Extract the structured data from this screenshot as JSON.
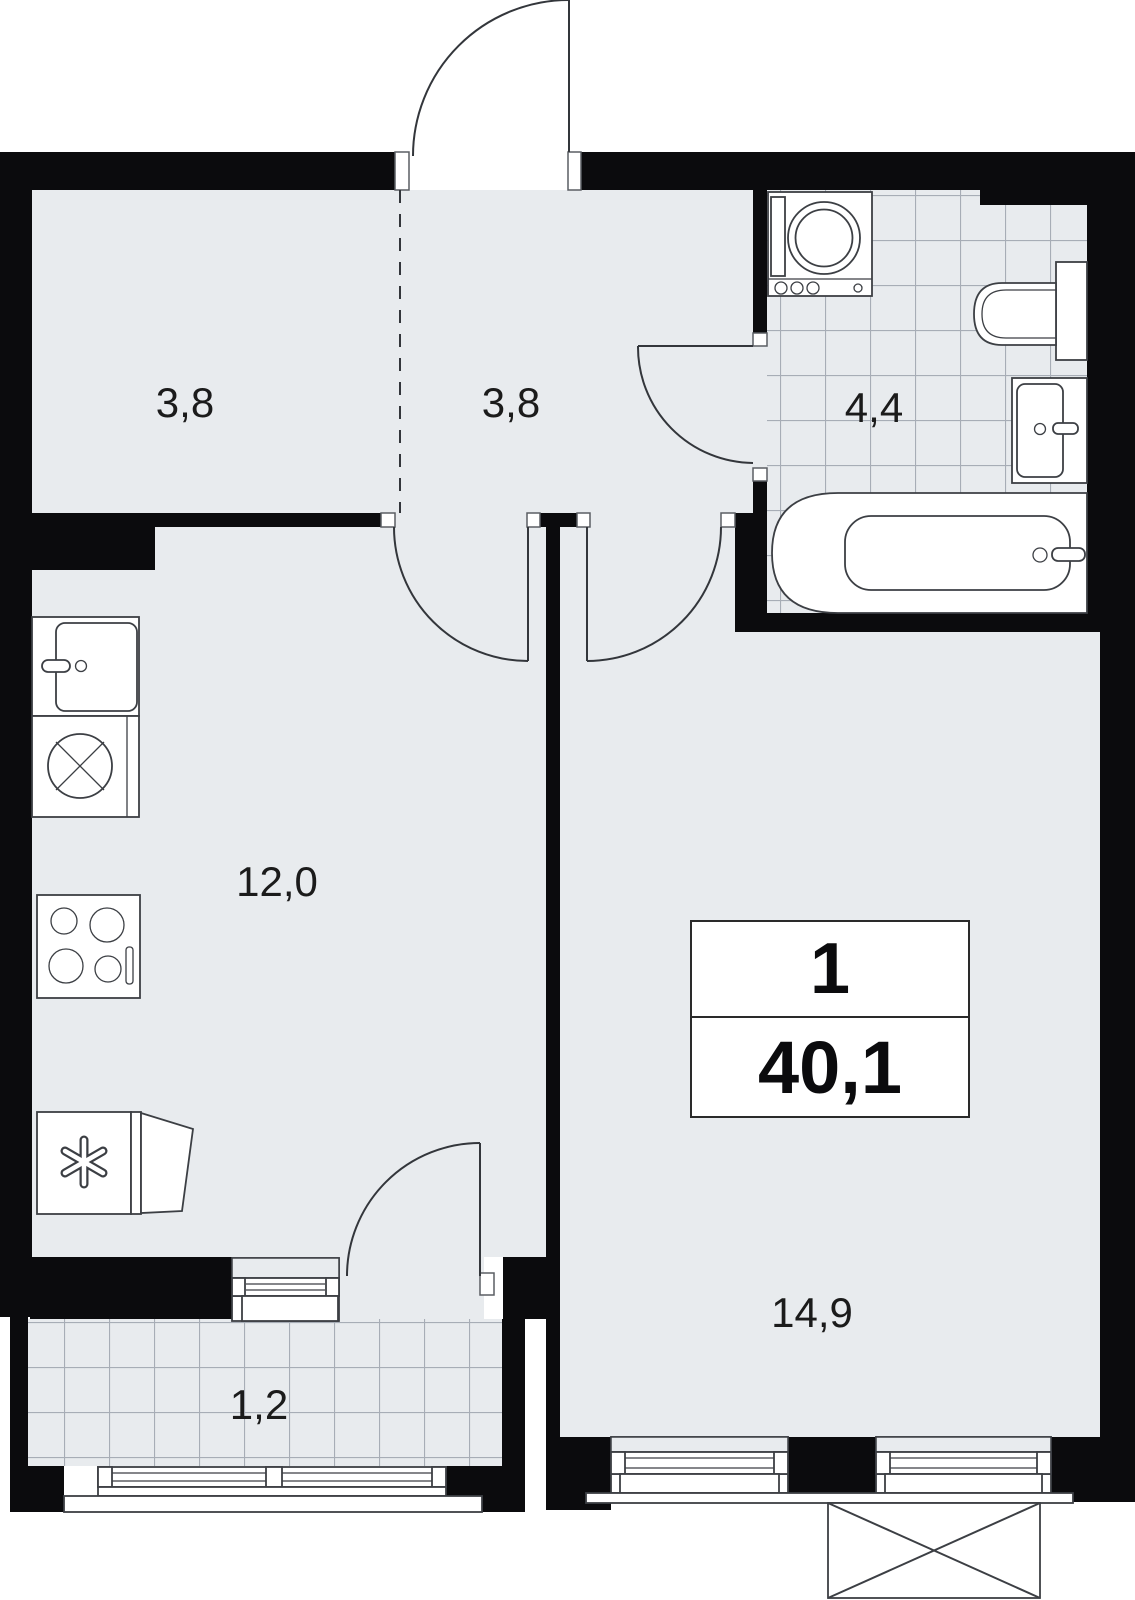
{
  "floorplan": {
    "summary": {
      "rooms_count": "1",
      "total_area": "40,1"
    },
    "rooms": [
      {
        "name": "wardrobe",
        "area": "3,8"
      },
      {
        "name": "hallway",
        "area": "3,8"
      },
      {
        "name": "bathroom",
        "area": "4,4"
      },
      {
        "name": "kitchen",
        "area": "12,0"
      },
      {
        "name": "living-room",
        "area": "14,9"
      },
      {
        "name": "balcony",
        "area": "1,2"
      }
    ],
    "colors": {
      "wall": "#0b0b0d",
      "floor": "#e8ebee",
      "tile_line": "#a7adb6",
      "outline": "#3c3f44"
    }
  }
}
